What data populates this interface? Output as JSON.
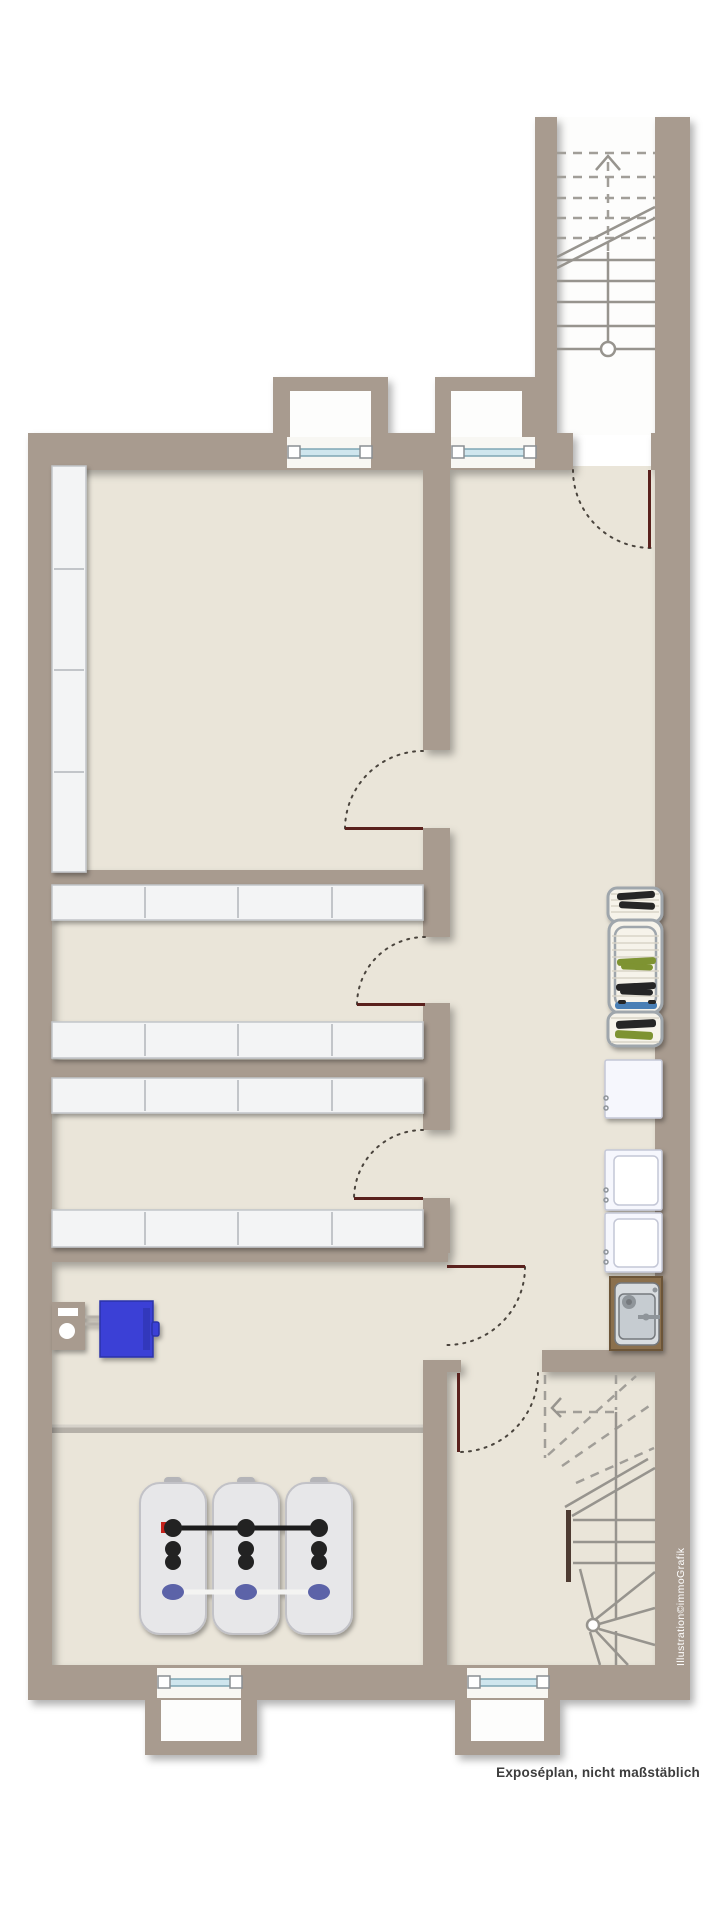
{
  "texts": {
    "caption": "Exposéplan, nicht maßstäblich",
    "watermark": "Illustration©immoGrafik"
  },
  "colors": {
    "outside": "#ffffff",
    "wall": "#a89b8f",
    "floor": "#eae5d9",
    "wellinterior": "#fdfdfc",
    "windowrecess": "#f8f7f3",
    "windowglass": "#cfe6ee",
    "windowframe": "#7fa6b4",
    "windowpost": "#ffffff",
    "windowpoststroke": "#8a8f93",
    "shelffill": "#f3f4f5",
    "shelfstroke": "#c2c5c9",
    "doorleaf": "#5a211d",
    "swingdots": "#4a443d",
    "stairline": "#97948e",
    "stairdash": "#a19e98",
    "stairstub": "#4e3b32",
    "newelfill": "#ffffff",
    "rackframe": "#9fa6ac",
    "rackbed": "#f6f3ea",
    "rackrung": "#d8d4c8",
    "laundryblack": "#262626",
    "laundrygreen": "#7e9330",
    "laundryblue": "#4a7fb5",
    "appliancefill": "#f6f7fd",
    "appliancestroke": "#c4c7d6",
    "applianceinner": "#ffffff",
    "counterwood": "#8b6f4e",
    "counterstroke": "#6c5538",
    "sinkouter": "#d9dde0",
    "sinkinner": "#c6ccd1",
    "sinkstroke": "#75797d",
    "drain": "#8f959a",
    "pedestal": "#a89b8f",
    "pedestalwhite": "#ffffff",
    "pipegray": "#b5b0a8",
    "pipelight": "#d6d2ca",
    "boilerblue": "#3a41d6",
    "boilerbluedark": "#2b31a8",
    "tankfill": "#e7e7e9",
    "tankshade": "#c2c2c7",
    "tankhandle": "#b4b4b8",
    "tankpipeblack": "#1d1d1d",
    "tankcapblack": "#232323",
    "tankcapblue": "#5c63a8",
    "tankpipewhite": "#f4f4f2",
    "tankred": "#c4201c",
    "captiontext": "#3d3d3d",
    "watermarktext": "#ffffff"
  },
  "inventory": {
    "windows": 4,
    "window_wells": 4,
    "doors": 6,
    "staircases": 2,
    "shelf_rows": 4,
    "shelf_columns": 1,
    "drying_racks": 3,
    "appliances": 3,
    "sink_units": 1,
    "heating_units": 1,
    "oil_tanks": 3
  }
}
